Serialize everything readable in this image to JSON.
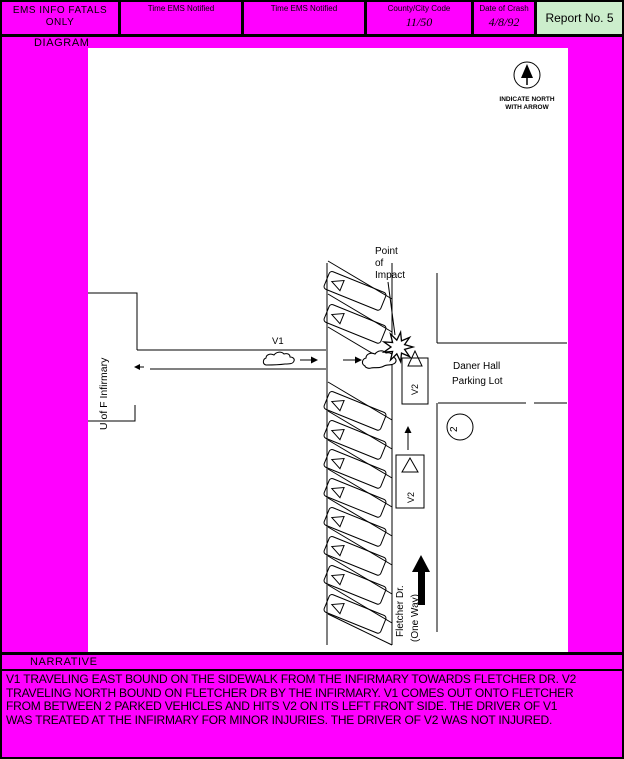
{
  "header": {
    "ems_label": "EMS INFO FATALS ONLY",
    "time_ems_1": "Time EMS Notified",
    "time_ems_2": "Time EMS Notified",
    "county_city_label": "County/City Code",
    "county_city_value": "11/50",
    "date_label": "Date of Crash",
    "date_value": "4/8/92",
    "report_no": "Report No. 5"
  },
  "sections": {
    "diagram_label": "DIAGRAM",
    "narrative_label": "NARRATIVE"
  },
  "diagram": {
    "north_note_line1": "INDICATE NORTH",
    "north_note_line2": "WITH ARROW",
    "building_label": "U of F Infirmary",
    "v1_label": "V1",
    "poi_line1": "Point",
    "poi_line2": "of",
    "poi_line3": "Impact",
    "daner_line1": "Daner Hall",
    "daner_line2": "Parking Lot",
    "v2_label_upper": "V2",
    "v2_label_lower": "V2",
    "street_line1": "Fletcher Dr.",
    "street_line2": "(One Way)",
    "circled_symbol": "2"
  },
  "narrative": {
    "lines": [
      "V1 TRAVELING EAST BOUND ON THE SIDEWALK FROM THE INFIRMARY TOWARDS FLETCHER DR.  V2",
      "TRAVELING NORTH BOUND ON FLETCHER DR BY THE INFIRMARY.  V1 COMES OUT ONTO FLETCHER",
      "FROM BETWEEN 2 PARKED VEHICLES AND HITS V2 ON ITS LEFT FRONT SIDE.  THE DRIVER OF V1",
      "WAS TREATED AT THE INFIRMARY FOR MINOR INJURIES.  THE DRIVER OF V2 WAS NOT INJURED."
    ]
  },
  "colors": {
    "magenta": "#FF00FF",
    "report_box_green": "#CCEECC"
  }
}
